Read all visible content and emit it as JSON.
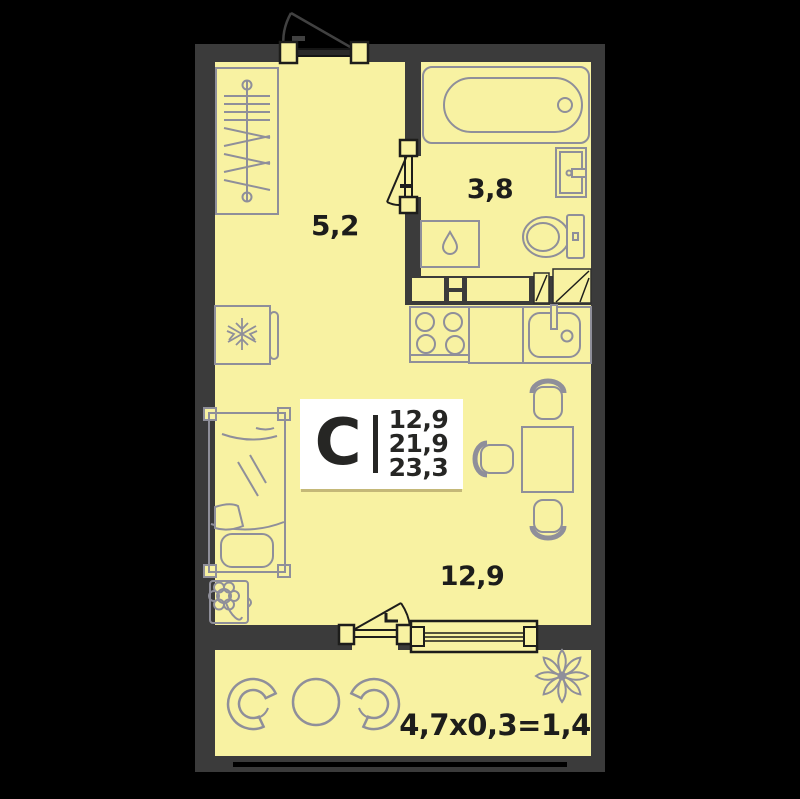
{
  "plan_card": {
    "type_letter": "С",
    "area_values": [
      "12,9",
      "21,9",
      "23,3"
    ]
  },
  "room_labels": {
    "hallway_area": "5,2",
    "bathroom_area": "3,8",
    "living_room_area": "12,9",
    "balcony_formula": "4,7x0,3=1,4"
  },
  "colors": {
    "background": "#000000",
    "wall": "#3b3b3b",
    "floor": "#f8f2a2",
    "furniture_line": "#8f8f9a",
    "hardware_line": "#1d1d1b",
    "text": "#1d1d1b",
    "card_background": "#ffffff"
  },
  "icons": {
    "fridge_icon": "snowflake",
    "washing_machine_icon": "water-drop",
    "plant_icon": "flower-in-pot",
    "balcony_ornament_icon": "eight-petal-flower"
  },
  "furniture_glyphs": [
    "wardrobe",
    "bathtub",
    "wash-basin",
    "toilet",
    "washing-machine",
    "ventilation-shaft",
    "fridge",
    "stove",
    "kitchen-counter",
    "kitchen-sink",
    "dining-table",
    "chair",
    "bed",
    "potted-plant",
    "balcony-armchair",
    "balcony-table",
    "entrance-door",
    "bathroom-door",
    "balcony-door",
    "window",
    "railing"
  ]
}
